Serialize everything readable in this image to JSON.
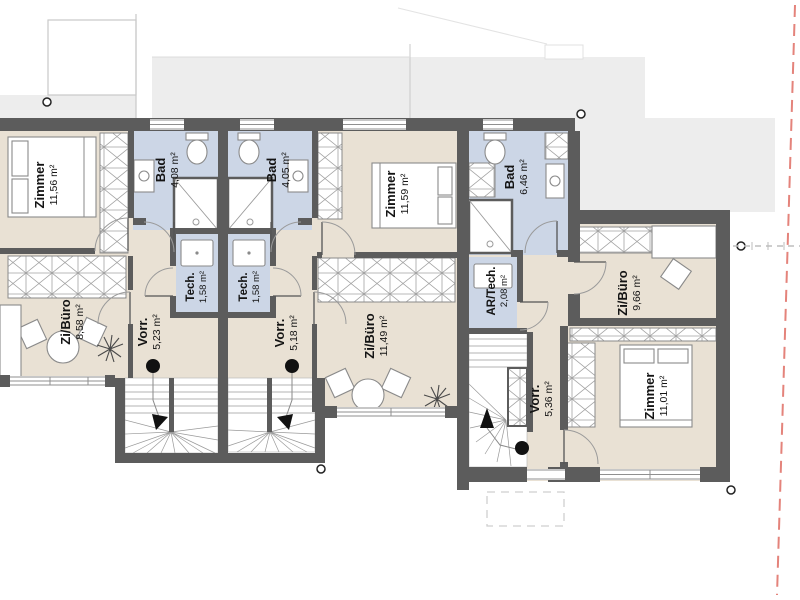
{
  "plan": {
    "title": "Obergeschoss Grundriss",
    "units": [
      {
        "rooms": [
          {
            "name": "Zimmer",
            "area": "11,56 m²"
          },
          {
            "name": "Bad",
            "area": "4,08 m²"
          },
          {
            "name": "Tech.",
            "area": "1,58 m²"
          },
          {
            "name": "Zi/Büro",
            "area": "8,58 m²"
          },
          {
            "name": "Vorr.",
            "area": "5,23 m²"
          }
        ]
      },
      {
        "rooms": [
          {
            "name": "Bad",
            "area": "4,05 m²"
          },
          {
            "name": "Tech.",
            "area": "1,58 m²"
          },
          {
            "name": "Zimmer",
            "area": "11,59 m²"
          },
          {
            "name": "Vorr.",
            "area": "5,18 m²"
          },
          {
            "name": "Zi/Büro",
            "area": "11,49 m²"
          }
        ]
      },
      {
        "rooms": [
          {
            "name": "Bad",
            "area": "6,46 m²"
          },
          {
            "name": "AR/Tech.",
            "area": "2,08 m²"
          },
          {
            "name": "Zi/Büro",
            "area": "9,66 m²"
          },
          {
            "name": "Vorr.",
            "area": "5,36 m²"
          },
          {
            "name": "Zimmer",
            "area": "11,01 m²"
          }
        ]
      }
    ]
  },
  "colors": {
    "wall": "#5c5c5c",
    "floor": "#e9e1d4",
    "wet_room": "#ccd6e6",
    "stair": "#ffffff",
    "boundary_line": "#e4837b",
    "roof_outline": "#ededed"
  }
}
